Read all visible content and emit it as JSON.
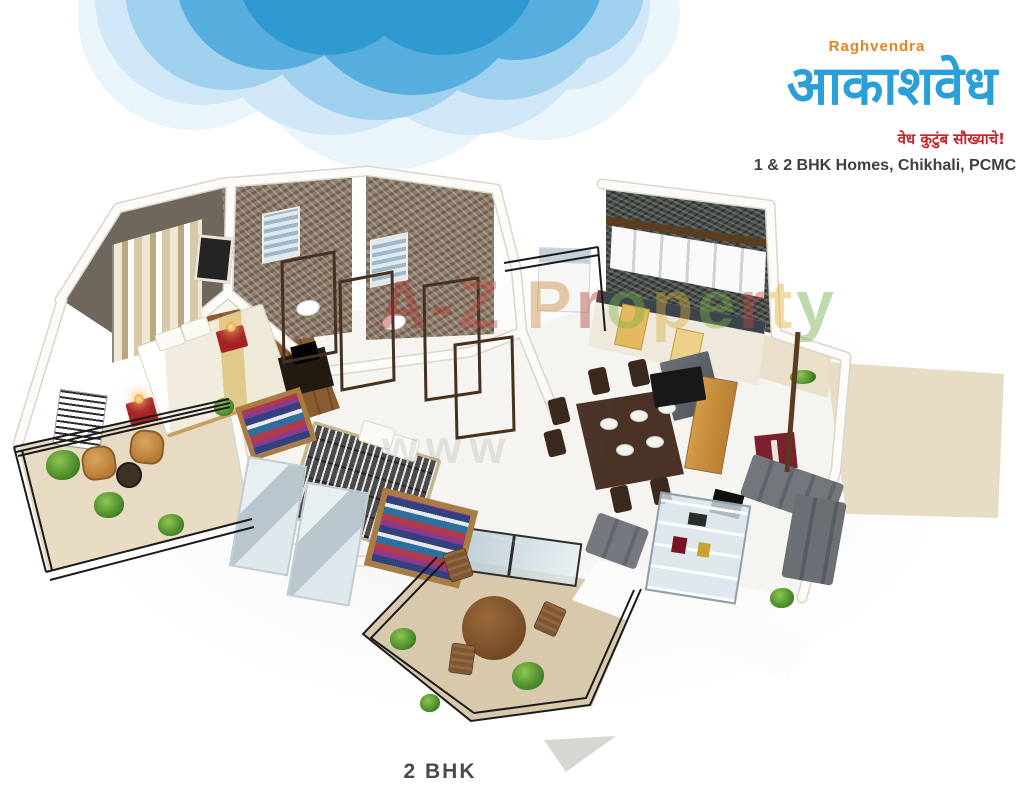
{
  "header": {
    "brand": "Raghvendra",
    "logo_title": "आकाशवेध",
    "tagline": "वेध कुटुंब सौख्याचे!",
    "subtitle": "1 & 2 BHK Homes, Chikhali, PCMC"
  },
  "watermark": {
    "line1": "A-Z Property",
    "line2": "www",
    "letter_colors": [
      "#a8352c",
      "#a8352c",
      "#bf4d45",
      "#000000",
      "#c9873b",
      "#b23a31",
      "#79b349",
      "#d8ae3a",
      "#79b349",
      "#c24b44",
      "#e3ac2e",
      "#6ca844"
    ]
  },
  "plan": {
    "label": "2 BHK"
  },
  "colors": {
    "logo_blue": "#2b9fd8",
    "brand_orange": "#e8821e",
    "tagline_red": "#c0272d",
    "cloud_blue": "#45a5d9",
    "maroon_accent": "#7c1f2e",
    "wall_taupe": "#6f665c",
    "brick_wall": "#8e7e6d",
    "kitchen_tile": "#454b46",
    "outdoor_beige": "#e6dac3",
    "wood_floor": "#8a5c30",
    "sofa_gray": "#5f646a",
    "railing_black": "#1b1b1b"
  }
}
